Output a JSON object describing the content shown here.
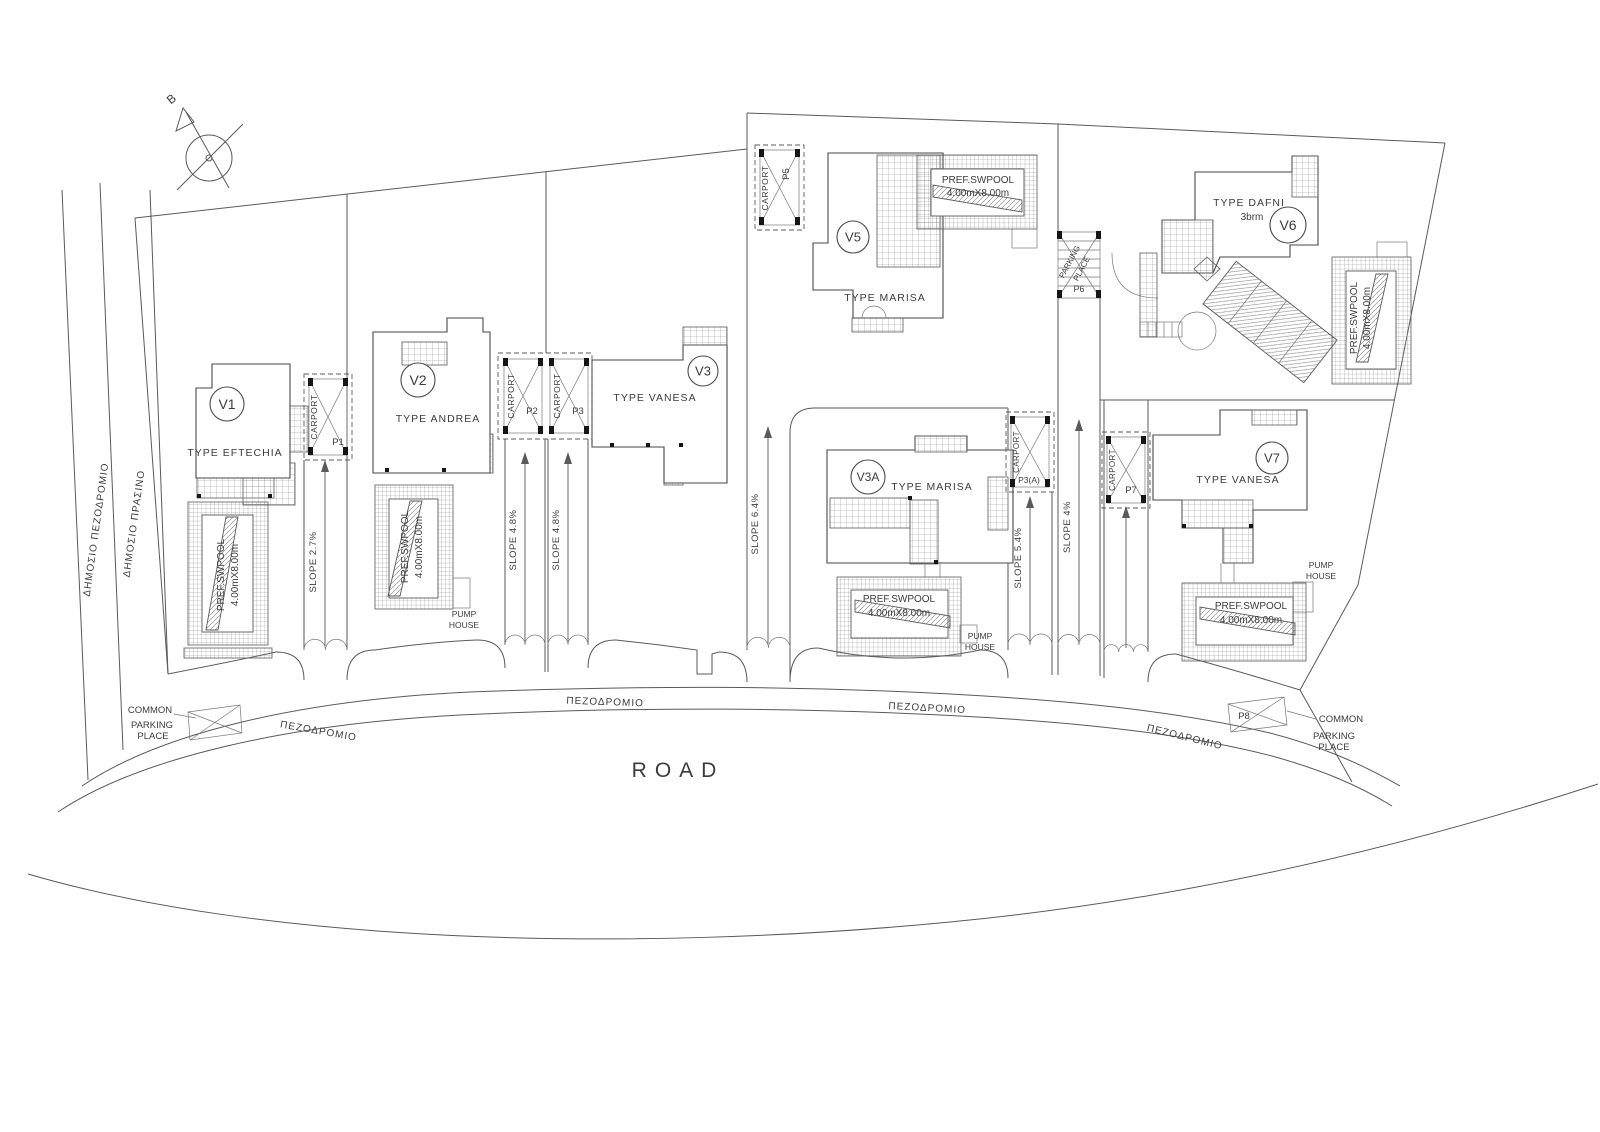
{
  "compass": {
    "label": "B"
  },
  "public_areas": {
    "sidewalk_label": "ΔΗΜΟΣΙΟ  ΠΕΖΟΔΡΟΜΙΟ",
    "green_label": "ΔΗΜΟΣΙΟ  ΠΡΑΣΙΝΟ"
  },
  "road": {
    "name": "ROAD",
    "sidewalk": "ΠΕΖΟΔΡΟΜΙΟ"
  },
  "villas": [
    {
      "id": "V1",
      "type": "TYPE  EFTECHIA"
    },
    {
      "id": "V2",
      "type": "TYPE  ANDREA"
    },
    {
      "id": "V3",
      "type": "TYPE  VANESA"
    },
    {
      "id": "V5",
      "type": "TYPE  MARISA"
    },
    {
      "id": "V6",
      "type": "TYPE  DAFNI",
      "extra": "3brm"
    },
    {
      "id": "V3A",
      "type": "TYPE  MARISA"
    },
    {
      "id": "V7",
      "type": "TYPE  VANESA"
    }
  ],
  "pool": {
    "line1": "PREF.SWPOOL",
    "line2": "4.00mX8.00m"
  },
  "carport_label": "CARPORT",
  "carports": [
    "P1",
    "P2",
    "P3",
    "P5",
    "P3(A)",
    "P7"
  ],
  "parking_place_p6": {
    "line1": "PARKING",
    "line2": "PLACE",
    "id": "P6"
  },
  "slopes": [
    "SLOPE 2.7%",
    "SLOPE 4.8%",
    "SLOPE 4.8%",
    "SLOPE 6.4%",
    "SLOPE 5.4%",
    "SLOPE 4%"
  ],
  "pump_house": {
    "line1": "PUMP",
    "line2": "HOUSE"
  },
  "common_parking": {
    "line1": "COMMON",
    "line2": "PARKING",
    "line3": "PLACE",
    "p8": "P8"
  }
}
